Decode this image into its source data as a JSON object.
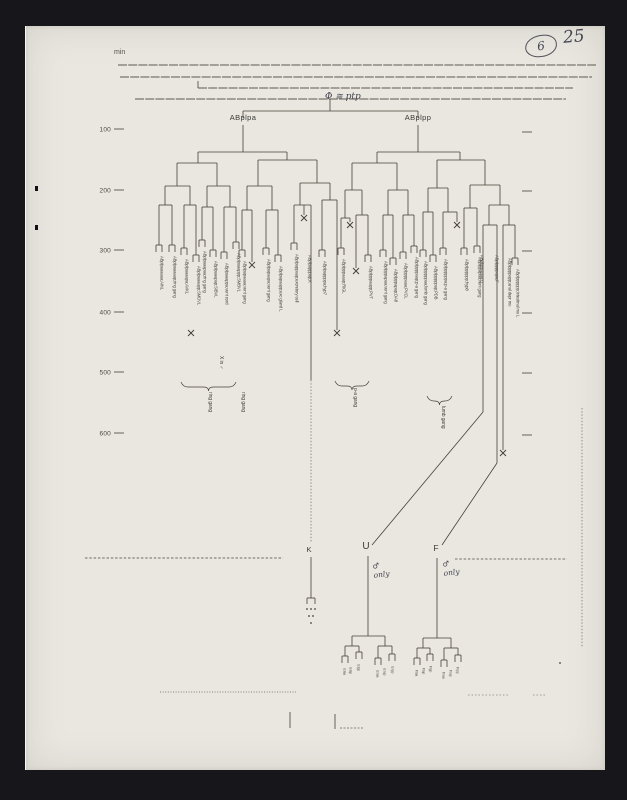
{
  "meta": {
    "unit": "min",
    "figure_number": "6",
    "page_number": "25",
    "root_annotation": "Φ ≅ ptp"
  },
  "tree_names": {
    "left": "ABplpa",
    "right": "ABplpp"
  },
  "kuf": {
    "k": "K",
    "u": "U",
    "f": "F",
    "male_only": "♂ only"
  },
  "figure": {
    "ink": "#454239",
    "top_rules_h": [
      [
        118,
        596,
        65
      ],
      [
        120,
        592,
        77
      ],
      [
        198,
        573,
        88
      ],
      [
        135,
        566,
        99
      ]
    ],
    "axis": {
      "left_ticks": [
        {
          "label": "100",
          "y": 129
        },
        {
          "label": "200",
          "y": 190
        },
        {
          "label": "300",
          "y": 250
        },
        {
          "label": "400",
          "y": 312
        },
        {
          "label": "500",
          "y": 372
        },
        {
          "label": "600",
          "y": 433
        }
      ],
      "right_tick_y": [
        132,
        191,
        251,
        313,
        373,
        435
      ]
    },
    "h": [
      [
        243,
        418,
        111
      ],
      [
        198,
        287,
        152
      ],
      [
        177,
        217,
        163
      ],
      [
        258,
        317,
        160
      ],
      [
        165,
        190,
        186
      ],
      [
        207,
        230,
        186
      ],
      [
        247,
        272,
        186
      ],
      [
        300,
        330,
        183
      ],
      [
        159,
        172,
        205
      ],
      [
        184,
        196,
        205
      ],
      [
        202,
        213,
        207
      ],
      [
        224,
        236,
        207
      ],
      [
        242,
        252,
        210
      ],
      [
        266,
        278,
        210
      ],
      [
        294,
        311,
        205
      ],
      [
        322,
        337,
        200
      ],
      [
        377,
        460,
        152
      ],
      [
        352,
        397,
        163
      ],
      [
        437,
        485,
        160
      ],
      [
        345,
        362,
        190
      ],
      [
        388,
        408,
        190
      ],
      [
        428,
        448,
        188
      ],
      [
        470,
        500,
        185
      ],
      [
        341,
        350,
        218
      ],
      [
        356,
        368,
        215
      ],
      [
        383,
        393,
        215
      ],
      [
        403,
        414,
        215
      ],
      [
        423,
        433,
        212
      ],
      [
        443,
        457,
        212
      ],
      [
        464,
        477,
        208
      ],
      [
        489,
        509,
        205
      ],
      [
        483,
        497,
        225
      ],
      [
        503,
        515,
        225
      ],
      [
        307,
        315,
        598
      ],
      [
        352,
        385,
        636
      ],
      [
        345,
        359,
        646
      ],
      [
        378,
        392,
        646
      ],
      [
        423,
        451,
        638
      ],
      [
        417,
        430,
        648
      ],
      [
        444,
        458,
        648
      ]
    ],
    "v": [
      [
        198,
        81,
        88
      ],
      [
        330,
        99,
        111
      ],
      [
        243,
        111,
        118
      ],
      [
        418,
        111,
        118
      ],
      [
        243,
        125,
        152
      ],
      [
        418,
        125,
        152
      ],
      [
        198,
        152,
        163
      ],
      [
        287,
        152,
        160
      ],
      [
        177,
        163,
        186
      ],
      [
        217,
        163,
        186
      ],
      [
        258,
        160,
        186
      ],
      [
        317,
        160,
        183
      ],
      [
        165,
        186,
        205
      ],
      [
        190,
        186,
        205
      ],
      [
        207,
        186,
        207
      ],
      [
        230,
        186,
        207
      ],
      [
        247,
        186,
        210
      ],
      [
        272,
        186,
        210
      ],
      [
        300,
        183,
        205
      ],
      [
        330,
        183,
        200
      ],
      [
        159,
        205,
        245
      ],
      [
        172,
        205,
        245
      ],
      [
        184,
        205,
        248
      ],
      [
        196,
        205,
        255
      ],
      [
        202,
        207,
        240
      ],
      [
        213,
        207,
        250
      ],
      [
        224,
        207,
        252
      ],
      [
        236,
        207,
        242
      ],
      [
        242,
        210,
        250
      ],
      [
        252,
        210,
        262
      ],
      [
        266,
        210,
        248
      ],
      [
        278,
        210,
        255
      ],
      [
        294,
        205,
        243
      ],
      [
        311,
        205,
        380
      ],
      [
        304,
        205,
        215
      ],
      [
        322,
        200,
        250
      ],
      [
        337,
        200,
        330
      ],
      [
        377,
        152,
        163
      ],
      [
        460,
        152,
        160
      ],
      [
        352,
        163,
        190
      ],
      [
        397,
        163,
        190
      ],
      [
        437,
        160,
        188
      ],
      [
        485,
        160,
        185
      ],
      [
        345,
        190,
        218
      ],
      [
        362,
        190,
        215
      ],
      [
        388,
        190,
        215
      ],
      [
        408,
        190,
        215
      ],
      [
        428,
        188,
        212
      ],
      [
        448,
        188,
        212
      ],
      [
        470,
        185,
        208
      ],
      [
        500,
        185,
        205
      ],
      [
        341,
        218,
        248
      ],
      [
        350,
        218,
        222
      ],
      [
        356,
        215,
        268
      ],
      [
        368,
        215,
        255
      ],
      [
        383,
        215,
        250
      ],
      [
        393,
        215,
        258
      ],
      [
        403,
        215,
        252
      ],
      [
        414,
        215,
        246
      ],
      [
        423,
        212,
        250
      ],
      [
        433,
        212,
        255
      ],
      [
        443,
        212,
        248
      ],
      [
        457,
        212,
        222
      ],
      [
        464,
        208,
        248
      ],
      [
        477,
        208,
        246
      ],
      [
        489,
        205,
        225
      ],
      [
        509,
        205,
        225
      ],
      [
        483,
        225,
        412
      ],
      [
        497,
        225,
        463
      ],
      [
        503,
        225,
        450
      ],
      [
        515,
        225,
        258
      ],
      [
        311,
        557,
        598
      ],
      [
        368,
        556,
        636
      ],
      [
        437,
        558,
        638
      ],
      [
        307,
        598,
        604
      ],
      [
        315,
        598,
        604
      ],
      [
        352,
        636,
        646
      ],
      [
        385,
        636,
        646
      ],
      [
        345,
        646,
        656
      ],
      [
        359,
        646,
        652
      ],
      [
        378,
        646,
        658
      ],
      [
        392,
        646,
        654
      ],
      [
        423,
        638,
        648
      ],
      [
        451,
        638,
        648
      ],
      [
        417,
        648,
        658
      ],
      [
        430,
        648,
        654
      ],
      [
        444,
        648,
        660
      ],
      [
        458,
        648,
        655
      ],
      [
        290,
        712,
        728
      ],
      [
        335,
        714,
        729
      ]
    ],
    "v_dashed": [
      [
        311,
        380,
        543
      ],
      [
        582,
        408,
        648
      ]
    ],
    "diagonals": [
      [
        483,
        412,
        372,
        545
      ],
      [
        497,
        463,
        442,
        545
      ]
    ],
    "pairs": [
      [
        159,
        245
      ],
      [
        172,
        245
      ],
      [
        184,
        248
      ],
      [
        196,
        255
      ],
      [
        202,
        240
      ],
      [
        213,
        250
      ],
      [
        224,
        252
      ],
      [
        236,
        242
      ],
      [
        242,
        250
      ],
      [
        266,
        248
      ],
      [
        278,
        255
      ],
      [
        294,
        243
      ],
      [
        322,
        250
      ],
      [
        341,
        248
      ],
      [
        368,
        255
      ],
      [
        383,
        250
      ],
      [
        393,
        258
      ],
      [
        403,
        252
      ],
      [
        414,
        246
      ],
      [
        423,
        250
      ],
      [
        433,
        255
      ],
      [
        443,
        248
      ],
      [
        464,
        248
      ],
      [
        477,
        246
      ],
      [
        515,
        258
      ],
      [
        345,
        656
      ],
      [
        359,
        652
      ],
      [
        378,
        658
      ],
      [
        392,
        654
      ],
      [
        417,
        658
      ],
      [
        430,
        654
      ],
      [
        444,
        660
      ],
      [
        458,
        655
      ]
    ],
    "deaths": [
      [
        304,
        218
      ],
      [
        350,
        225
      ],
      [
        457,
        225
      ],
      [
        356,
        271
      ],
      [
        252,
        265
      ],
      [
        337,
        333
      ],
      [
        191,
        333
      ],
      [
        503,
        453
      ]
    ],
    "braces": [
      [
        181,
        236,
        382
      ],
      [
        335,
        369,
        381
      ],
      [
        427,
        452,
        396
      ]
    ],
    "leaf_labels": [
      {
        "x": 159,
        "y": 256,
        "t": "ABplpaaaaaa;AINL"
      },
      {
        "x": 172,
        "y": 256,
        "t": "ABplpaaaaap;ring gang"
      },
      {
        "x": 184,
        "y": 259,
        "t": "ABplpaaaapa;AVKL"
      },
      {
        "x": 196,
        "y": 266,
        "t": "ABplpaaaapp;SMDVL"
      },
      {
        "x": 202,
        "y": 251,
        "t": "ABplpaaapaa;ring gang"
      },
      {
        "x": 213,
        "y": 261,
        "t": "ABplpaaapap;SIBVL"
      },
      {
        "x": 224,
        "y": 263,
        "t": "ABplpaaappa;vent cord"
      },
      {
        "x": 236,
        "y": 253,
        "t": "ABplpaaappp;SMBVL"
      },
      {
        "x": 242,
        "y": 261,
        "t": "ABplpapaaaa;vent gang"
      },
      {
        "x": 266,
        "y": 259,
        "t": "ABplpapaapa;vent gang"
      },
      {
        "x": 278,
        "y": 266,
        "t": "ABplpapaapp;exc gland L"
      },
      {
        "x": 294,
        "y": 254,
        "t": "ABplpappaap;excretory cell"
      },
      {
        "x": 307,
        "y": 255,
        "t": "ABplpapppap;K"
      },
      {
        "x": 322,
        "y": 261,
        "t": "ABplpappppa;hyp7"
      },
      {
        "x": 341,
        "y": 259,
        "t": "ABplpppaaap;RIGL"
      },
      {
        "x": 368,
        "y": 266,
        "t": "ABplpppaapp;PVT"
      },
      {
        "x": 383,
        "y": 261,
        "t": "ABplpppapaa;vent gang"
      },
      {
        "x": 393,
        "y": 269,
        "t": "ABplpppapap;DA8"
      },
      {
        "x": 403,
        "y": 263,
        "t": "ABplppppaaa;PVCL"
      },
      {
        "x": 414,
        "y": 257,
        "t": "ABplppppaap;p-a gang"
      },
      {
        "x": 423,
        "y": 261,
        "t": "ABplpppppaa;lumb gang"
      },
      {
        "x": 433,
        "y": 266,
        "t": "ABplpppppap;PDB"
      },
      {
        "x": 443,
        "y": 259,
        "t": "ABplppppppa;p-a gang"
      },
      {
        "x": 464,
        "y": 259,
        "t": "ABplpppppp;hyp8"
      },
      {
        "x": 477,
        "y": 257,
        "t": "ABplppapaa;vent gang"
      },
      {
        "x": 479,
        "y": 255,
        "t": "ABplpppaaaa;U"
      },
      {
        "x": 494,
        "y": 255,
        "t": "ABplppppapa;F"
      },
      {
        "x": 507,
        "y": 258,
        "t": "ABplppppapp;anal depr mu"
      },
      {
        "x": 515,
        "y": 269,
        "t": "ABplpppppp;intestinal mu L"
      }
    ],
    "annotations": [
      {
        "x": 207,
        "y": 392,
        "t": "ring gang"
      },
      {
        "x": 240,
        "y": 392,
        "t": "ring gang"
      },
      {
        "x": 352,
        "y": 388,
        "t": "p-a gang"
      },
      {
        "x": 440,
        "y": 406,
        "t": "lumb gang"
      },
      {
        "x": 218,
        "y": 356,
        "t": "X in ♂"
      }
    ],
    "subtree_labels": [
      {
        "x": 342,
        "y": 668,
        "t": "U.laa"
      },
      {
        "x": 348,
        "y": 667,
        "t": "U.lap"
      },
      {
        "x": 356,
        "y": 664,
        "t": "U.lpp"
      },
      {
        "x": 375,
        "y": 670,
        "t": "U.raa"
      },
      {
        "x": 382,
        "y": 668,
        "t": "U.rap"
      },
      {
        "x": 390,
        "y": 666,
        "t": "U.rpp"
      },
      {
        "x": 414,
        "y": 670,
        "t": "F.laa"
      },
      {
        "x": 421,
        "y": 668,
        "t": "F.lap"
      },
      {
        "x": 428,
        "y": 666,
        "t": "F.lpp"
      },
      {
        "x": 441,
        "y": 672,
        "t": "F.raa"
      },
      {
        "x": 448,
        "y": 670,
        "t": "F.rap"
      },
      {
        "x": 455,
        "y": 667,
        "t": "F.rpp"
      }
    ],
    "dashes_h": [
      {
        "x1": 85,
        "x2": 283,
        "y": 558,
        "dash": "2.5,1.8",
        "op": 0.75
      },
      {
        "x1": 455,
        "x2": 567,
        "y": 559,
        "dash": "2.5,1.8",
        "op": 0.7
      },
      {
        "x1": 160,
        "x2": 296,
        "y": 692,
        "dash": "1,1.6",
        "op": 0.5,
        "w": 1.2
      },
      {
        "x1": 468,
        "x2": 510,
        "y": 695,
        "dash": "1.5,2",
        "op": 0.45
      },
      {
        "x1": 533,
        "x2": 547,
        "y": 695,
        "dash": "1.5,2",
        "op": 0.45
      },
      {
        "x1": 340,
        "x2": 364,
        "y": 728,
        "dash": "2,1.5",
        "op": 0.6
      }
    ],
    "dots": [
      [
        307,
        609
      ],
      [
        311,
        609
      ],
      [
        315,
        609
      ],
      [
        309,
        616
      ],
      [
        313,
        616
      ],
      [
        311,
        623
      ],
      [
        560,
        663
      ]
    ],
    "specks": [
      [
        35,
        186
      ],
      [
        35,
        225
      ]
    ]
  }
}
